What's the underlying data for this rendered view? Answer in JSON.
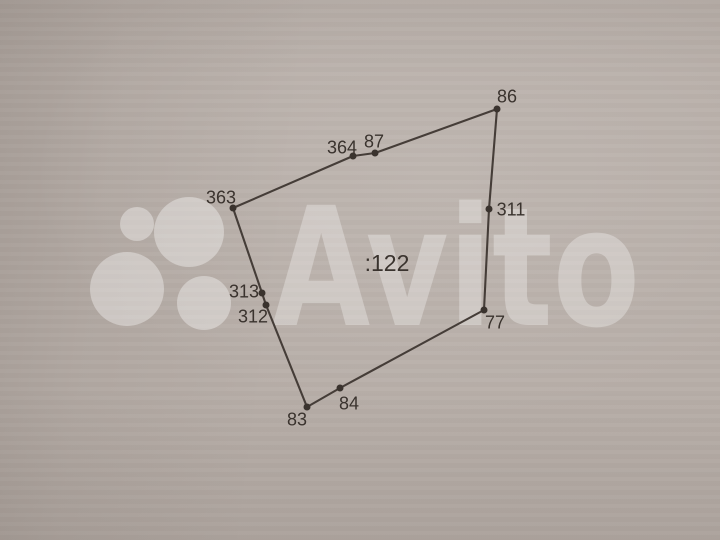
{
  "watermark": {
    "brand_text": "Avito",
    "color": "#ffffff",
    "text_opacity": 0.3,
    "circles_opacity": 0.36,
    "text_pos": {
      "x": 272,
      "baseline_y": 325,
      "font_size": 165,
      "text_length": 368
    },
    "logo_circles": [
      {
        "cx": 137,
        "cy": 224,
        "r": 17
      },
      {
        "cx": 189,
        "cy": 232,
        "r": 35
      },
      {
        "cx": 127,
        "cy": 289,
        "r": 37
      },
      {
        "cx": 204,
        "cy": 303,
        "r": 27
      }
    ]
  },
  "parcel": {
    "cadastral_label": ":122",
    "cadastral_label_pos": {
      "x": 387,
      "y": 263
    },
    "vertices": [
      {
        "label": "86",
        "x": 497,
        "y": 109,
        "lx": 507,
        "ly": 96
      },
      {
        "label": "311",
        "x": 489,
        "y": 209,
        "lx": 511,
        "ly": 209
      },
      {
        "label": "77",
        "x": 484,
        "y": 310,
        "lx": 495,
        "ly": 322
      },
      {
        "label": "84",
        "x": 340,
        "y": 388,
        "lx": 349,
        "ly": 403
      },
      {
        "label": "83",
        "x": 307,
        "y": 407,
        "lx": 297,
        "ly": 419
      },
      {
        "label": "312",
        "x": 266,
        "y": 305,
        "lx": 253,
        "ly": 316
      },
      {
        "label": "313",
        "x": 262,
        "y": 293,
        "lx": 244,
        "ly": 291
      },
      {
        "label": "363",
        "x": 233,
        "y": 208,
        "lx": 221,
        "ly": 197
      },
      {
        "label": "364",
        "x": 353,
        "y": 156,
        "lx": 342,
        "ly": 147
      },
      {
        "label": "87",
        "x": 375,
        "y": 153,
        "lx": 374,
        "ly": 141
      }
    ]
  },
  "colors": {
    "paper": "#b7aea8",
    "boundary_line": "#453d38",
    "vertex_dot": "#3a332e",
    "label_text": "#3a332e"
  }
}
